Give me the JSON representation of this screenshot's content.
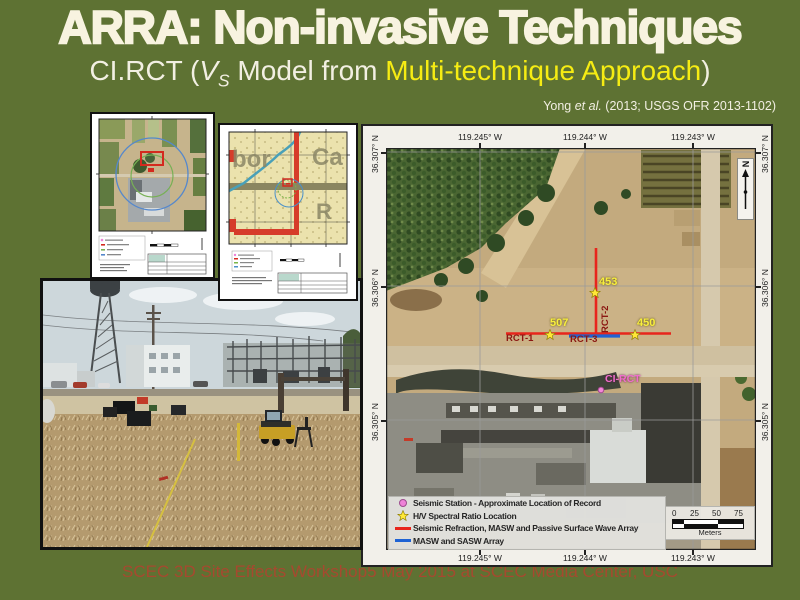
{
  "slide": {
    "title": "ARRA: Non-invasive Techniques",
    "subtitle": {
      "pre": "CI.RCT (",
      "var": "V",
      "var_sub": "S",
      "mid": " Model from ",
      "highlight": "Multi-technique Approach",
      "post": ")"
    },
    "attribution": {
      "pre": "Yong ",
      "italic": "et al.",
      "post": " (2013; USGS OFR 2013-1102)"
    },
    "footer": "SCEC 3D Site Effects Workshop5 May 2015 at SCEC Media Center, USC"
  },
  "main_map": {
    "x_axis_labels": [
      "119.245° W",
      "119.244° W",
      "119.243° W"
    ],
    "y_axis_labels": [
      "36.307° N",
      "36.306° N",
      "36.305° N"
    ],
    "north_label": "N",
    "annotations": {
      "rct1": "RCT-1",
      "rct2": "RCT-2",
      "rct3": "RCT-3",
      "hv_453": "453",
      "hv_507": "507",
      "hv_450": "450",
      "station": "CI-RCT"
    },
    "legend": {
      "items": [
        {
          "symbol": "seismic-station-dot",
          "label": "Seismic Station - Approximate Location of Record"
        },
        {
          "symbol": "hv-star",
          "label": "H/V Spectral Ratio Location"
        },
        {
          "symbol": "red-array-line",
          "label": "Seismic Refraction, MASW and Passive Surface Wave Array"
        },
        {
          "symbol": "blue-array-line",
          "label": "MASW and SASW Array"
        }
      ]
    },
    "scale_bar": {
      "t0": "0",
      "t25": "25",
      "t50": "50",
      "t75": "75",
      "unit": "Meters"
    }
  },
  "inset_topo_labels": {
    "l1": "bor",
    "l2": "Ca",
    "l3": "R"
  },
  "colors": {
    "background": "#5e7233",
    "title_text": "#f8f3e0",
    "subtitle_highlight": "#f6ec13",
    "footer_text": "#a6492f",
    "array_red": "#e8251c",
    "array_blue": "#1f63d4",
    "station_pink": "#ee82d8",
    "hv_star_yellow": "#ffe837",
    "rct_label_red": "#8b1712"
  }
}
